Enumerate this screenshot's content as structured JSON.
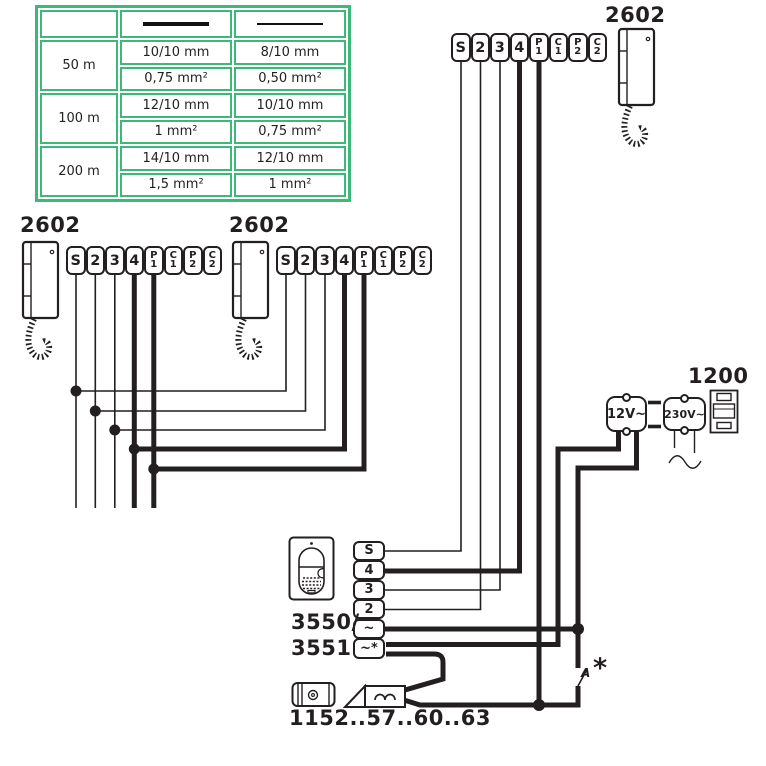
{
  "colors": {
    "accent_green": "#3cb878",
    "ink": "#231f20"
  },
  "wire_table": {
    "groups": [
      {
        "distance": "50 m",
        "rows": [
          [
            "10/10 mm",
            "8/10 mm"
          ],
          [
            "0,75 mm²",
            "0,50 mm²"
          ]
        ]
      },
      {
        "distance": "100 m",
        "rows": [
          [
            "12/10 mm",
            "10/10 mm"
          ],
          [
            "1  mm²",
            "0,75 mm²"
          ]
        ]
      },
      {
        "distance": "200 m",
        "rows": [
          [
            "14/10 mm",
            "12/10 mm"
          ],
          [
            "1,5 mm²",
            "1 mm²"
          ]
        ]
      }
    ]
  },
  "handset": {
    "model": "2602"
  },
  "terminal_strip": [
    {
      "line1": "S"
    },
    {
      "line1": "2"
    },
    {
      "line1": "3"
    },
    {
      "line1": "4"
    },
    {
      "line1": "P",
      "line2": "1"
    },
    {
      "line1": "C",
      "line2": "1"
    },
    {
      "line1": "P",
      "line2": "2"
    },
    {
      "line1": "C",
      "line2": "2"
    }
  ],
  "door_station": {
    "model_line1": "3550/",
    "model_line2": "3551",
    "terminals": [
      "S",
      "4",
      "3",
      "2",
      "~",
      "~*"
    ]
  },
  "lock": {
    "model": "1152..57..60..63"
  },
  "psu": {
    "model": "1200",
    "secondary": "12V~",
    "primary": "230V~"
  },
  "switch": {
    "label": "A",
    "footnote": "*"
  }
}
